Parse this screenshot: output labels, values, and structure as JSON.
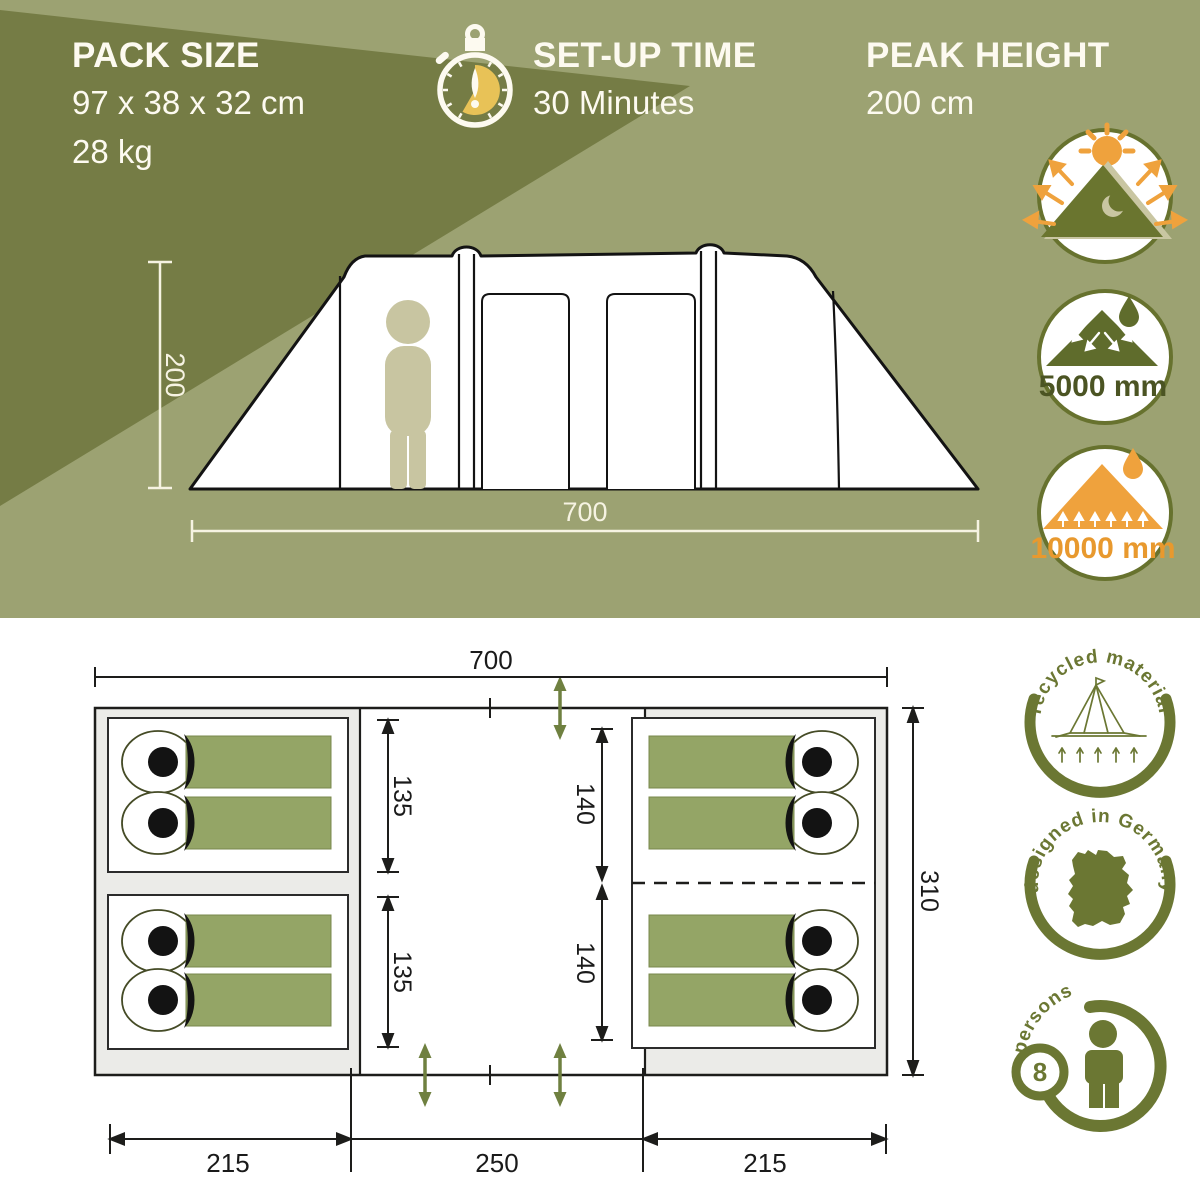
{
  "hero": {
    "pack": {
      "title": "PACK SIZE",
      "dimensions": "97 x 38 x 32 cm",
      "weight": "28 kg"
    },
    "setup": {
      "title": "SET-UP TIME",
      "value": "30 Minutes"
    },
    "peak": {
      "title": "PEAK HEIGHT",
      "value": "200 cm"
    },
    "tent_diagram": {
      "height_cm": "200",
      "width_cm": "700"
    },
    "ratings": {
      "flysheet": "5000 mm",
      "groundsheet": "10000 mm"
    }
  },
  "floorplan": {
    "width": "700",
    "depth": "310",
    "left_cabin_top_depth": "135",
    "left_cabin_bottom_depth": "135",
    "right_cabin_top_depth": "140",
    "right_cabin_bottom_depth": "140",
    "segment_left": "215",
    "segment_middle": "250",
    "segment_right": "215"
  },
  "features": {
    "recycled": "recycled material",
    "designed": "designed in Germany",
    "persons_word": "persons",
    "persons_count": "8"
  },
  "icons": {
    "stopwatch": "stopwatch-icon",
    "uv_protection": "sun-reflection-tent-icon",
    "flysheet_water": "rain-on-tent-icon",
    "ground_water": "ground-water-tent-icon",
    "recycled": "line-tent-icon",
    "designed": "germany-map-icon",
    "persons": "person-icon"
  },
  "colors": {
    "olive": "#9ca272",
    "olive_dark": "#757c45",
    "badge_green": "#6b7733",
    "triangle_green": "#6a752f",
    "orange": "#efa23d",
    "gold": "#e8c257",
    "bag_green": "#94a566",
    "arrow_green": "#6f8040",
    "cream": "#fdfaf0"
  }
}
